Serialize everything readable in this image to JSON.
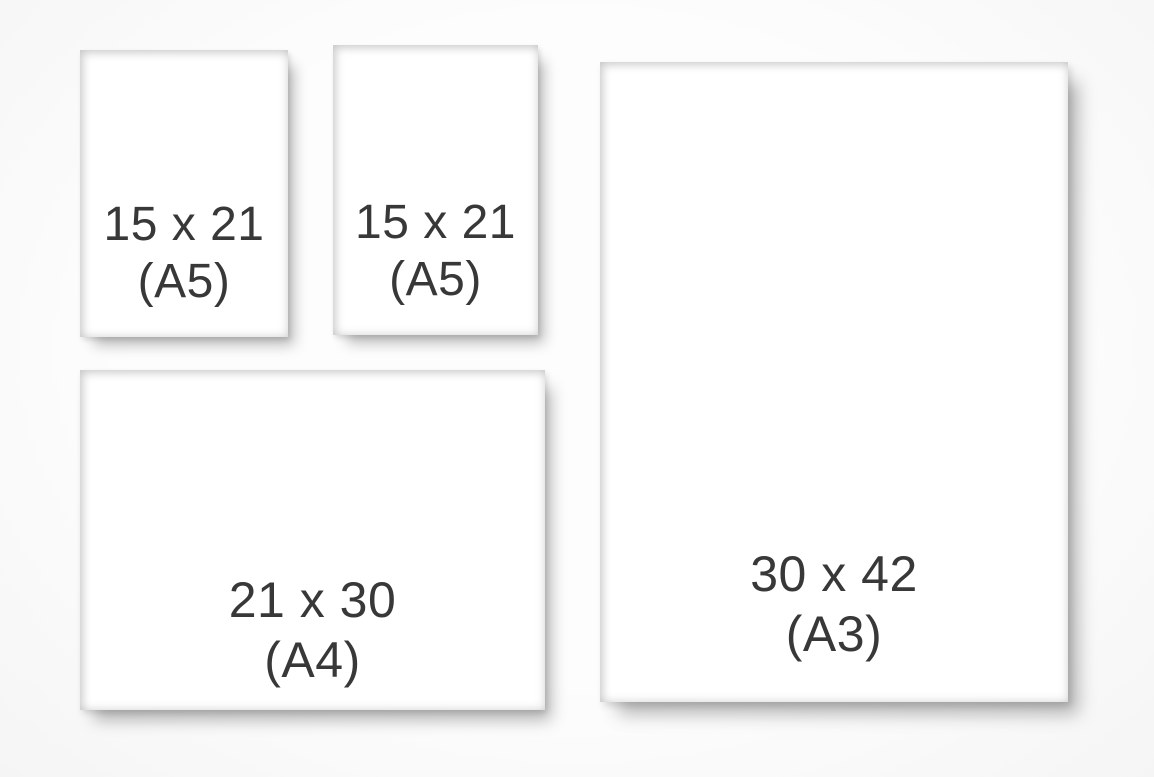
{
  "scene": {
    "background_color": "#fcfcfc",
    "frame_color": "#2c2c2e",
    "paper_color": "#ffffff",
    "label_color": "#383838"
  },
  "frames": [
    {
      "name": "a5-top-left",
      "dimensions": "15 x 21",
      "format": "(A5)"
    },
    {
      "name": "a5-top-right",
      "dimensions": "15 x 21",
      "format": "(A5)"
    },
    {
      "name": "a4-bottom-left",
      "dimensions": "21 x 30",
      "format": "(A4)"
    },
    {
      "name": "a3-right",
      "dimensions": "30 x 42",
      "format": "(A3)"
    }
  ]
}
